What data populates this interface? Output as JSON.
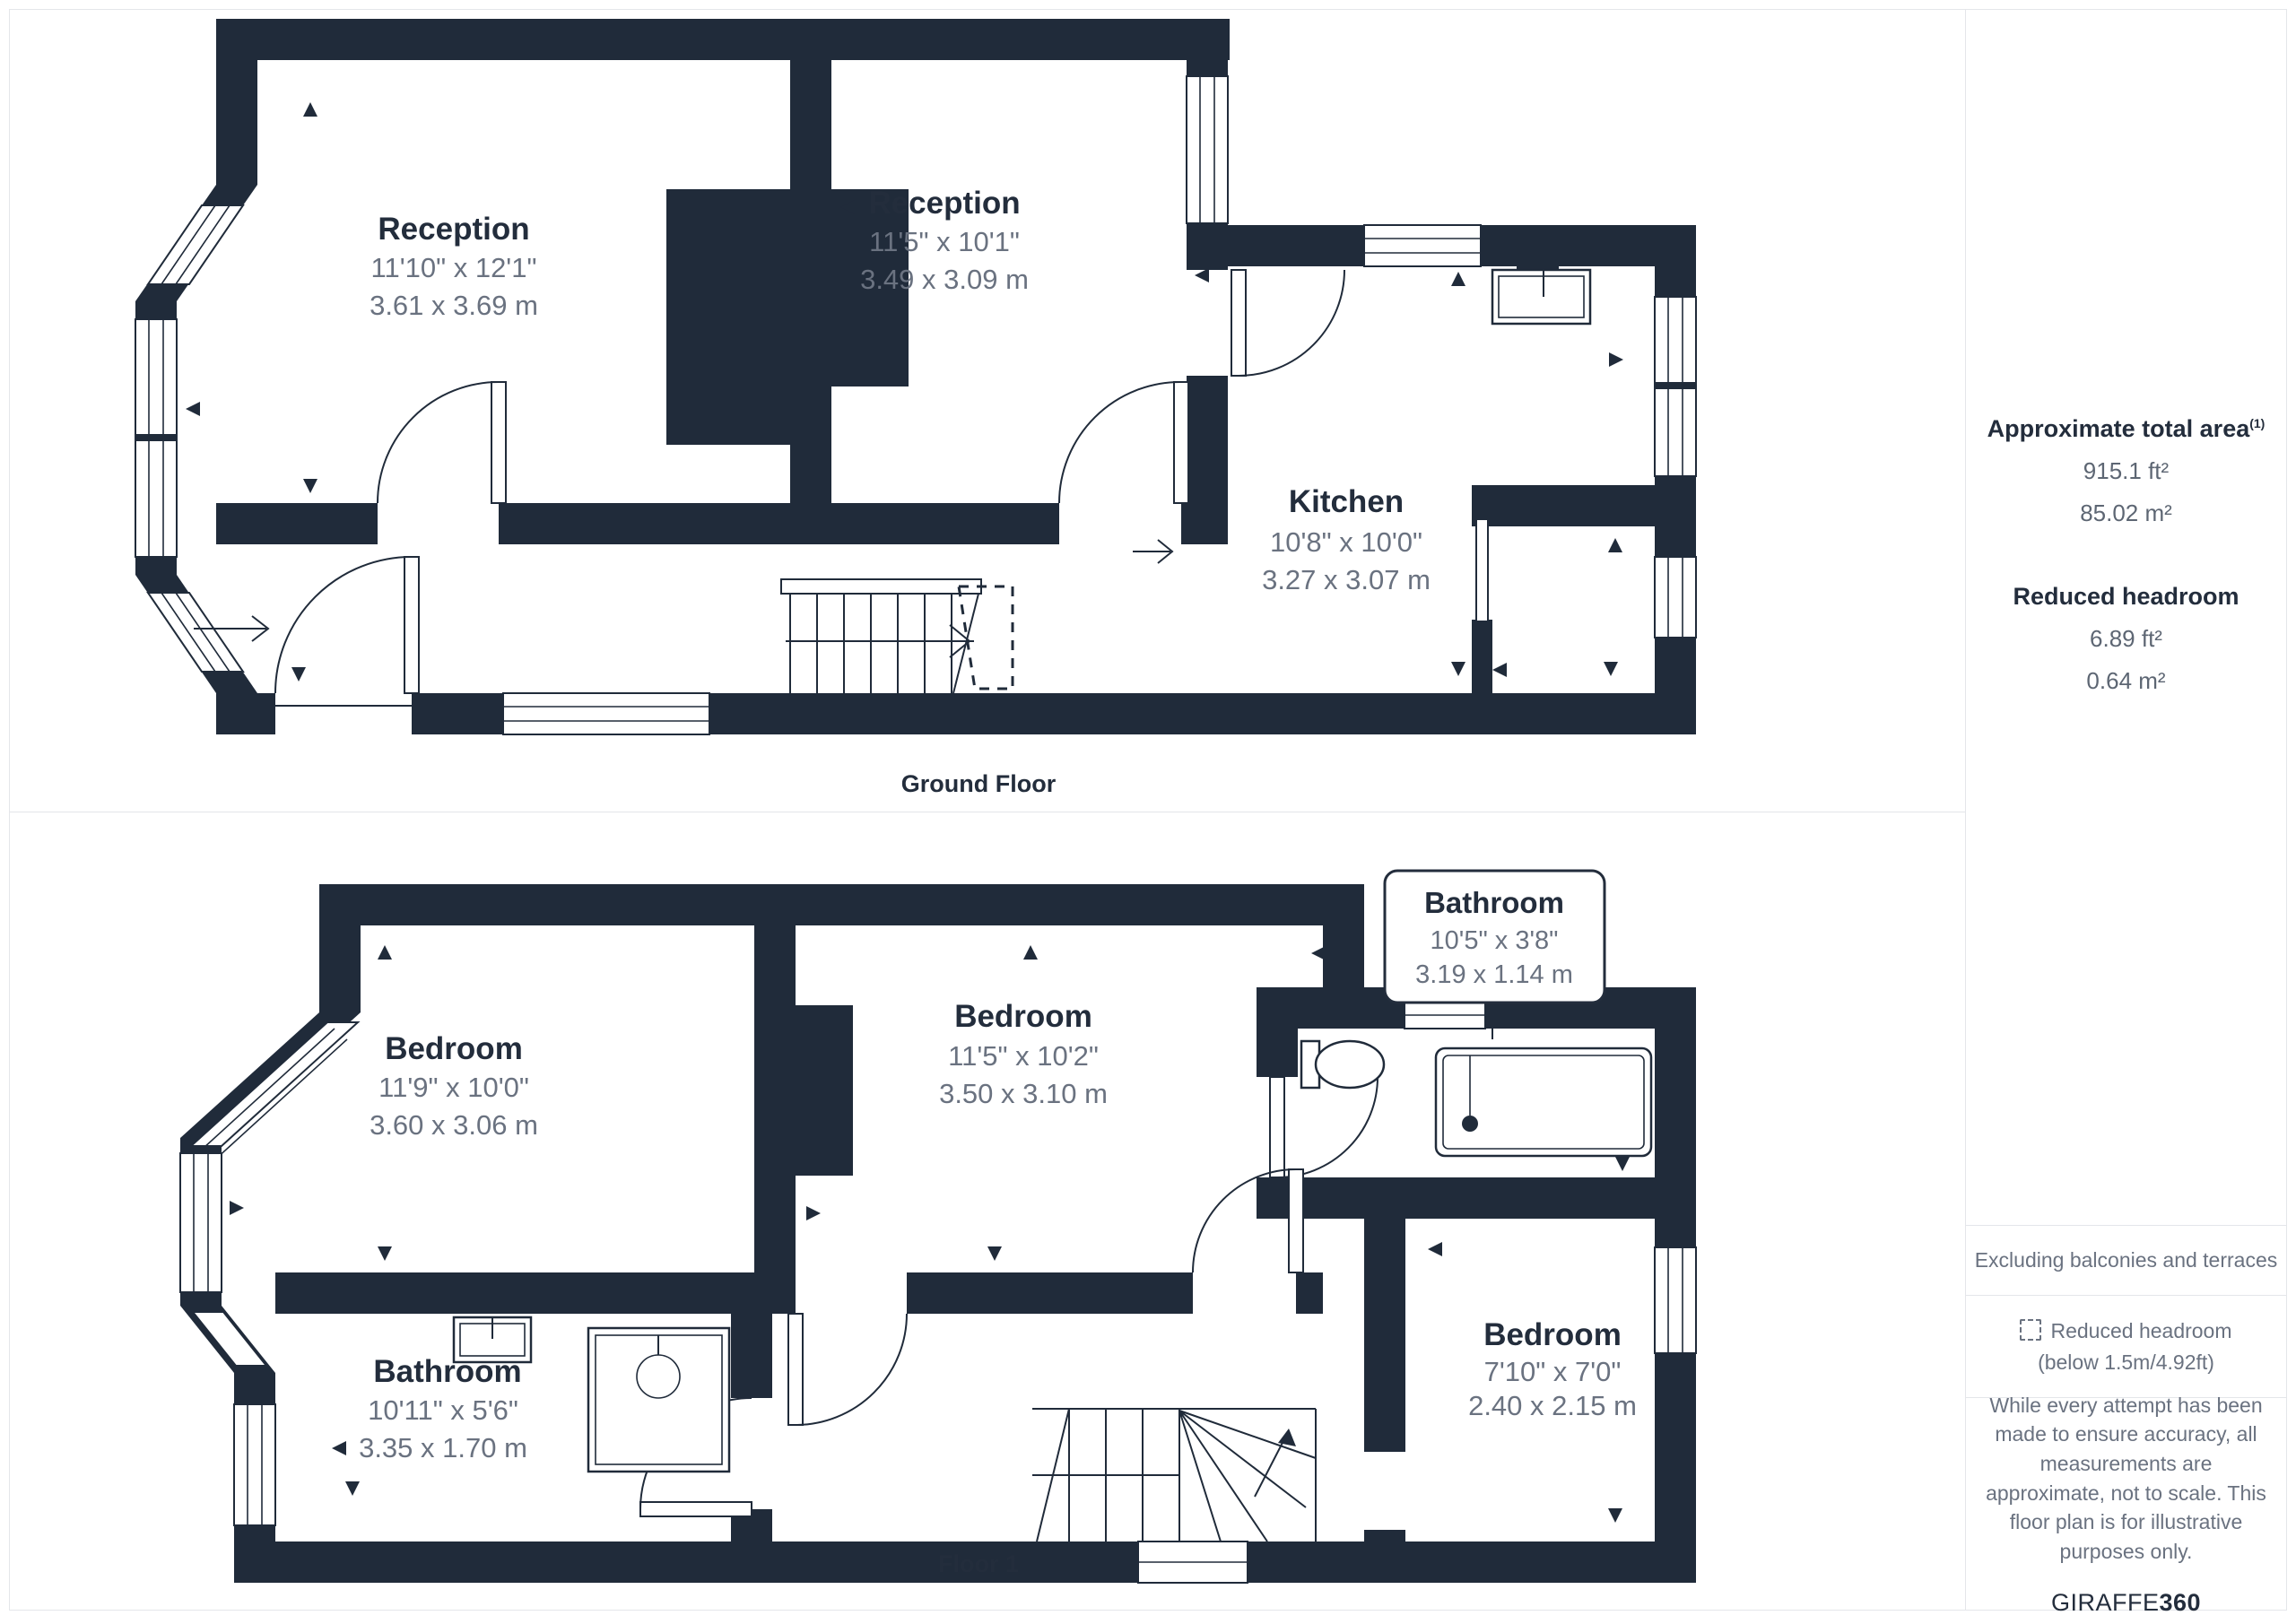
{
  "floors": [
    {
      "caption": "Ground Floor",
      "rooms": [
        {
          "name": "Reception",
          "imperial": "11'10\" x 12'1\"",
          "metric": "3.61 x 3.69 m"
        },
        {
          "name": "Reception",
          "imperial": "11'5\" x 10'1\"",
          "metric": "3.49 x 3.09 m"
        },
        {
          "name": "Kitchen",
          "imperial": "10'8\" x 10'0\"",
          "metric": "3.27 x 3.07 m"
        }
      ]
    },
    {
      "caption": "Floor 1",
      "rooms": [
        {
          "name": "Bedroom",
          "imperial": "11'9\" x 10'0\"",
          "metric": "3.60 x 3.06 m"
        },
        {
          "name": "Bedroom",
          "imperial": "11'5\" x 10'2\"",
          "metric": "3.50 x 3.10 m"
        },
        {
          "name": "Bathroom",
          "imperial": "10'5\" x 3'8\"",
          "metric": "3.19 x 1.14 m"
        },
        {
          "name": "Bathroom",
          "imperial": "10'11\" x 5'6\"",
          "metric": "3.35 x 1.70 m"
        },
        {
          "name": "Bedroom",
          "imperial": "7'10\" x 7'0\"",
          "metric": "2.40 x 2.15 m"
        }
      ]
    }
  ],
  "sidebar": {
    "total_area_label": "Approximate total area",
    "total_area_sup": "(1)",
    "total_area_ft": "915.1 ft²",
    "total_area_m": "85.02 m²",
    "reduced_headroom_label": "Reduced headroom",
    "reduced_headroom_ft": "6.89 ft²",
    "reduced_headroom_m": "0.64 m²",
    "excluding_note": "Excluding balconies and terraces",
    "legend_reduced_headroom_line1": "Reduced headroom",
    "legend_reduced_headroom_line2": "(below 1.5m/4.92ft)",
    "disclaimer": "While every attempt has been made to ensure accuracy, all measurements are approximate, not to scale. This floor plan is for illustrative purposes only.",
    "brand_name": "GIRAFFE",
    "brand_number": "360"
  },
  "colors": {
    "wall": "#202b3a",
    "room_title": "#232d3c",
    "dimension_text": "#6a7280",
    "panel_border": "#e4e6ea"
  }
}
